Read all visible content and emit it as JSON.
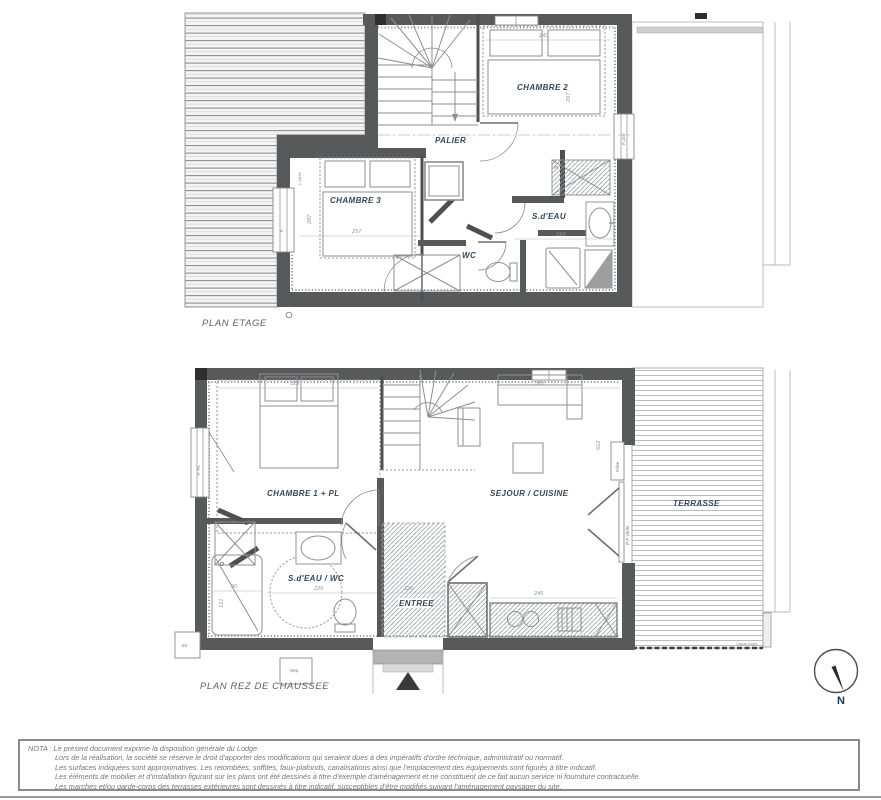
{
  "plan_etage": {
    "title": "PLAN ETAGE",
    "rooms": {
      "chambre2": "CHAMBRE 2",
      "palier": "PALIER",
      "chambre3": "CHAMBRE 3",
      "sdeau": "S.d'EAU",
      "wc": "WC"
    },
    "windows": {
      "left": "F.",
      "left_small": "L.Vitrée",
      "right": "F. priv"
    },
    "closet": "Pl.",
    "dims": {
      "chambre2_w": "243",
      "chambre2_h": "267",
      "chambre3_w": "257",
      "chambre3_h": "287",
      "sdeau_w": "193"
    }
  },
  "plan_rdc": {
    "title": "PLAN REZ DE CHAUSSEE",
    "rooms": {
      "chambre1": "CHAMBRE 1 + PL",
      "sejour": "SEJOUR / CUISINE",
      "sdeau_wc": "S.d'EAU / WC",
      "entree": "ENTREE",
      "terrasse": "TERRASSE"
    },
    "windows": {
      "left": "F. PL",
      "fixe": "F.fixe",
      "porte_fenetre": "P-F Vitrée",
      "garde_corps": "Garde-corps"
    },
    "boxes": {
      "left": "Eo",
      "bottom": "Oep"
    },
    "dims": {
      "chambre1_w": "323",
      "sejour_w": "385",
      "sejour_h": "512",
      "cuisine_w": "245",
      "shower_w": "90",
      "shower_h": "121",
      "sdeau_w": "226",
      "entree_w": "126"
    }
  },
  "compass": {
    "label": "N"
  },
  "nota": {
    "lines": [
      "NOTA : Le présent document exprime la disposition générale du Lodge.",
      "Lors de la réalisation, la société se réserve le droit d'apporter des modifications qui seraient dues à des impératifs d'ordre technique, administratif ou normatif.",
      "Les surfaces indiquées sont approximatives. Les retombées, soffites, faux-plafonds, canalisations ainsi que l'emplacement des équipements sont figurés à titre indicatif.",
      "Les éléments de mobilier et d'installation figurant sur les plans ont été dessinés à titre d'exemple d'aménagement et ne constituent de ce fait aucun service ni fourniture contractuelle.",
      "Les marches et/ou garde-corps des terrasses extérieures sont dessinés à titre indicatif, susceptibles d'être modifiés suivant l'aménagement paysager du site."
    ]
  },
  "colors": {
    "wall": "#58595b",
    "label": "#33475f",
    "dim": "#8a97ad",
    "roofline": "#9b9b9b",
    "deckline": "#b5b5b5",
    "nota": "#767676"
  }
}
